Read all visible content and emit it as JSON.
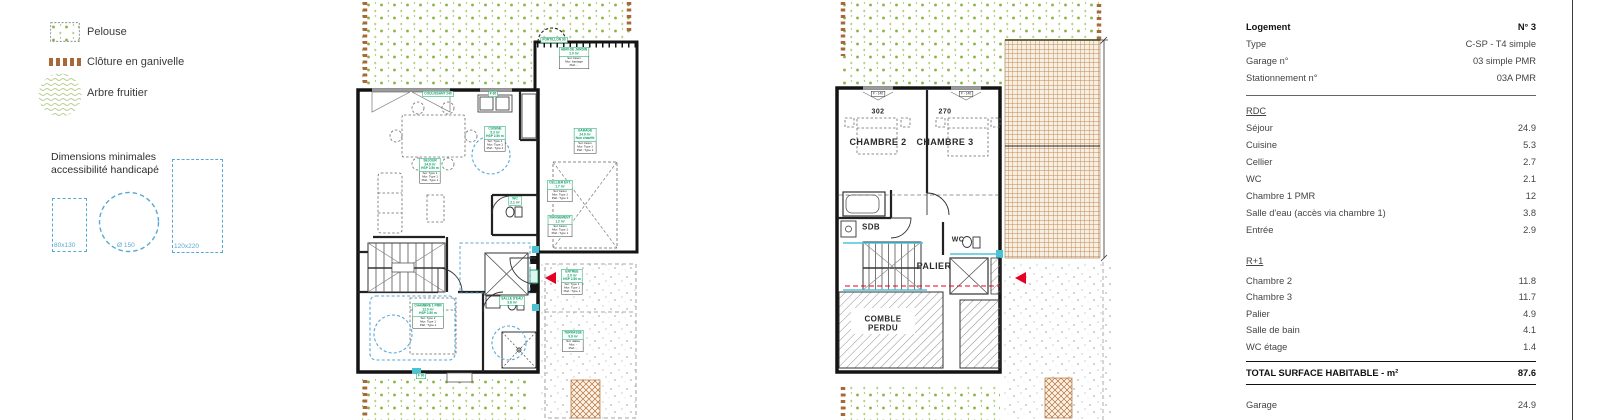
{
  "legend": {
    "items": [
      {
        "id": "pelouse",
        "label": "Pelouse"
      },
      {
        "id": "cloture",
        "label": "Clôture en ganivelle"
      },
      {
        "id": "arbre",
        "label": "Arbre fruitier"
      }
    ],
    "accessibility": {
      "title": [
        "Dimensions minimales",
        "accessibilité handicapé"
      ],
      "dims": [
        "80x130",
        "Ø 150",
        "120x220"
      ]
    }
  },
  "plans": {
    "rdc": {
      "labels": [
        {
          "x": 86,
          "y": 85,
          "type": "tag",
          "head": [
            "COULISSANT 240"
          ]
        },
        {
          "x": 141,
          "y": 85,
          "type": "tag",
          "head": [
            "F 60"
          ]
        },
        {
          "x": 202,
          "y": 31,
          "type": "tag",
          "head": [
            "PORTILLON 90"
          ]
        },
        {
          "x": 222,
          "y": 47,
          "type": "room",
          "head": [
            "ABRI DE JARDIN",
            "2.0 m²"
          ],
          "body": [
            "Sol: béton",
            "Mur: bardage",
            "Plaf.: -"
          ]
        },
        {
          "x": 233,
          "y": 128,
          "type": "room",
          "head": [
            "GARAGE",
            "24.9 m²",
            "Non chauffé"
          ],
          "body": [
            "Sol: béton",
            "Mur: Type 1",
            "Plaf.: Type 1"
          ]
        },
        {
          "x": 208,
          "y": 180,
          "type": "room",
          "head": [
            "CELLIER EXT.",
            "1.7 m²"
          ],
          "body": [
            "Sol: béton",
            "Mur: Type 1",
            "Plaf.: Type 1"
          ]
        },
        {
          "x": 208,
          "y": 215,
          "type": "room",
          "head": [
            "RANGEMENT",
            "1.2 m²"
          ],
          "body": [
            "Sol: béton",
            "Mur: Type 1",
            "Plaf.: Type 1"
          ]
        },
        {
          "x": 143,
          "y": 126,
          "type": "room",
          "head": [
            "CUISINE",
            "5.3 m²",
            "HSP 2.50 m"
          ],
          "body": [
            "Sol: Type 1",
            "Mur: Type 1",
            "Plaf.: Type 1"
          ]
        },
        {
          "x": 78,
          "y": 158,
          "type": "room",
          "head": [
            "SEJOUR",
            "24.9 m²",
            "HSP 2.50 m"
          ],
          "body": [
            "Sol: Type 1",
            "Mur: Type 1",
            "Plaf.: Type 1"
          ]
        },
        {
          "x": 163,
          "y": 196,
          "type": "tag",
          "head": [
            "WC",
            "2.1 m²"
          ]
        },
        {
          "x": 76,
          "y": 303,
          "type": "room",
          "head": [
            "CHAMBRE 1 PMR",
            "12.0 m²",
            "HSP 2.50 m"
          ],
          "body": [
            "Sol: Type 2",
            "Mur: Type 1",
            "Plaf.: Type 1"
          ]
        },
        {
          "x": 160,
          "y": 296,
          "type": "tag",
          "head": [
            "SALLE D'EAU",
            "3.8 m²"
          ]
        },
        {
          "x": 220,
          "y": 269,
          "type": "room",
          "head": [
            "ENTREE",
            "2.9 m²",
            "HSP 2.50 m"
          ],
          "body": [
            "Sol: Type 1",
            "Mur: Type 1",
            "Plaf.: Type 1"
          ]
        },
        {
          "x": 221,
          "y": 330,
          "type": "room",
          "head": [
            "TERRASSE",
            "9.9 m²"
          ],
          "body": [
            "Sol: dalles",
            "Mur: -",
            "Plaf.: -"
          ]
        },
        {
          "x": 69,
          "y": 367,
          "type": "tag",
          "head": [
            "F 90"
          ]
        }
      ],
      "texts": []
    },
    "r1": {
      "labels": [
        {
          "x": 63,
          "y": 85,
          "type": "wtag",
          "head": [
            "F - 140"
          ]
        },
        {
          "x": 151,
          "y": 85,
          "type": "wtag",
          "head": [
            "F - 140"
          ]
        }
      ],
      "texts": [
        {
          "x": 63,
          "y": 107,
          "t": "302",
          "fs": 7
        },
        {
          "x": 130,
          "y": 107,
          "t": "270",
          "fs": 7
        },
        {
          "x": 63,
          "y": 137,
          "t": "CHAMBRE 2",
          "fs": 9
        },
        {
          "x": 130,
          "y": 137,
          "t": "CHAMBRE 3",
          "fs": 9
        },
        {
          "x": 56,
          "y": 223,
          "t": "SDB",
          "fs": 8
        },
        {
          "x": 119,
          "y": 261,
          "t": "PALIER",
          "fs": 9
        },
        {
          "x": 143,
          "y": 235,
          "t": "WC",
          "fs": 7
        },
        {
          "x": 68,
          "y": 315,
          "t": "COMBLE",
          "fs": 8
        },
        {
          "x": 68,
          "y": 324,
          "t": "PERDU",
          "fs": 8
        }
      ]
    }
  },
  "panel": {
    "info_rows": [
      {
        "label": "Logement",
        "value": "N° 3",
        "bold": true
      },
      {
        "label": "Type",
        "value": "C-SP - T4 simple"
      },
      {
        "label": "Garage n°",
        "value": "03 simple PMR"
      },
      {
        "label": "Stationnement n°",
        "value": "03A PMR"
      }
    ],
    "sections": [
      {
        "title": "RDC",
        "rows": [
          [
            "Séjour",
            "24.9"
          ],
          [
            "Cuisine",
            "5.3"
          ],
          [
            "Cellier",
            "2.7"
          ],
          [
            "WC",
            "2.1"
          ],
          [
            "Chambre 1 PMR",
            "12"
          ],
          [
            "Salle d'eau (accès via chambre 1)",
            "3.8"
          ],
          [
            "Entrée",
            "2.9"
          ]
        ]
      },
      {
        "title": "R+1",
        "rows": [
          [
            "Chambre 2",
            "11.8"
          ],
          [
            "Chambre 3",
            "11.7"
          ],
          [
            "Palier",
            "4.9"
          ],
          [
            "Salle de bain",
            "4.1"
          ],
          [
            "WC étage",
            "1.4"
          ]
        ]
      }
    ],
    "total": {
      "label": "TOTAL SURFACE HABITABLE - m²",
      "value": "87.6"
    },
    "annex_rows": [
      [
        "Garage",
        "24.9"
      ]
    ]
  },
  "colors": {
    "label_green": "#0a9f63",
    "access_blue": "#58a9d4",
    "fence_brown": "#a8693a",
    "arrow_red": "#e60023",
    "lawn_green": "#86b23e",
    "tile_brown": "#c08552"
  }
}
